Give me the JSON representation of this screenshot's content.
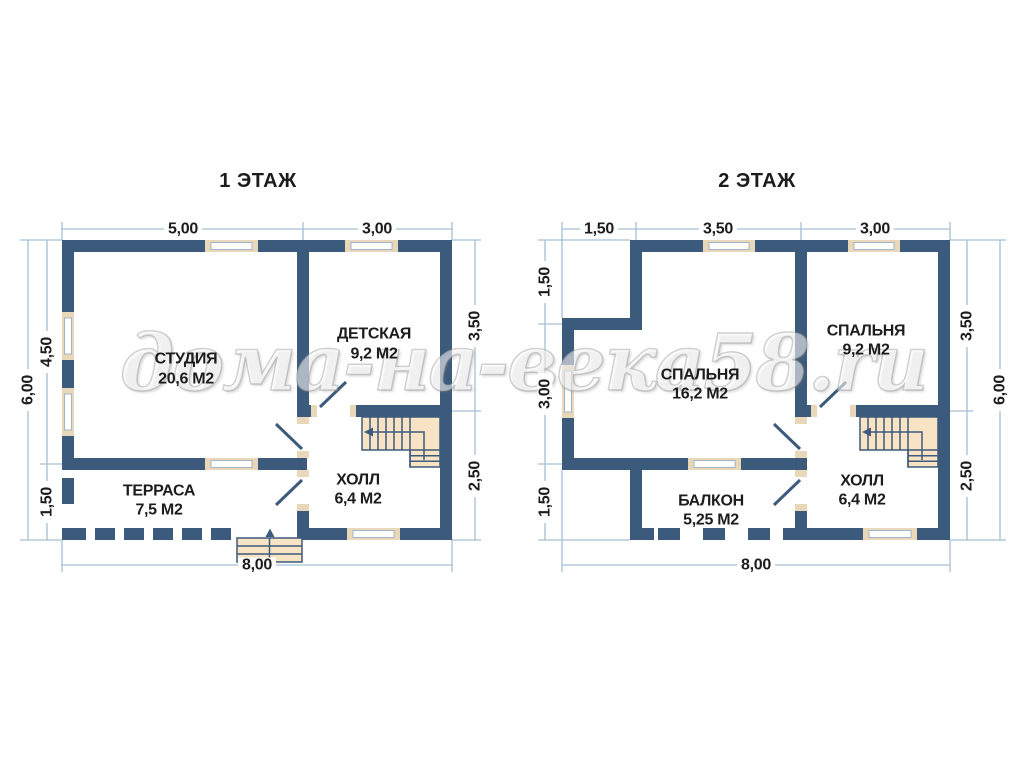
{
  "watermark": {
    "text": "дома-на-века58.ru"
  },
  "floors": [
    {
      "title": "1 ЭТАЖ",
      "rooms": [
        {
          "name": "СТУДИЯ",
          "area": "20,6 М2"
        },
        {
          "name": "ДЕТСКАЯ",
          "area": "9,2 М2"
        },
        {
          "name": "ХОЛЛ",
          "area": "6,4 М2"
        },
        {
          "name": "ТЕРРАСА",
          "area": "7,5 М2"
        }
      ],
      "dimensions": {
        "top": [
          "5,00",
          "3,00"
        ],
        "left_outer": "6,00",
        "left_inner": [
          "4,50",
          "1,50"
        ],
        "right": [
          "3,50",
          "2,50"
        ],
        "bottom": "8,00"
      }
    },
    {
      "title": "2 ЭТАЖ",
      "rooms": [
        {
          "name": "СПАЛЬНЯ",
          "area": "16,2 М2"
        },
        {
          "name": "СПАЛЬНЯ",
          "area": "9,2 М2"
        },
        {
          "name": "ХОЛЛ",
          "area": "6,4 М2"
        },
        {
          "name": "БАЛКОН",
          "area": "5,25 М2"
        }
      ],
      "dimensions": {
        "top": [
          "1,50",
          "3,50",
          "3,00"
        ],
        "left": [
          "1,50",
          "3,00",
          "1,50"
        ],
        "right_inner": [
          "3,50",
          "2,50"
        ],
        "right_outer": "6,00",
        "bottom": "8,00"
      }
    }
  ],
  "colors": {
    "wall": "#3c5a7c",
    "window_trim": "#e9d7ba",
    "stair_fill": "#f8e4c4",
    "dimension_line": "#a6bfd4",
    "text": "#1c1c1c"
  }
}
